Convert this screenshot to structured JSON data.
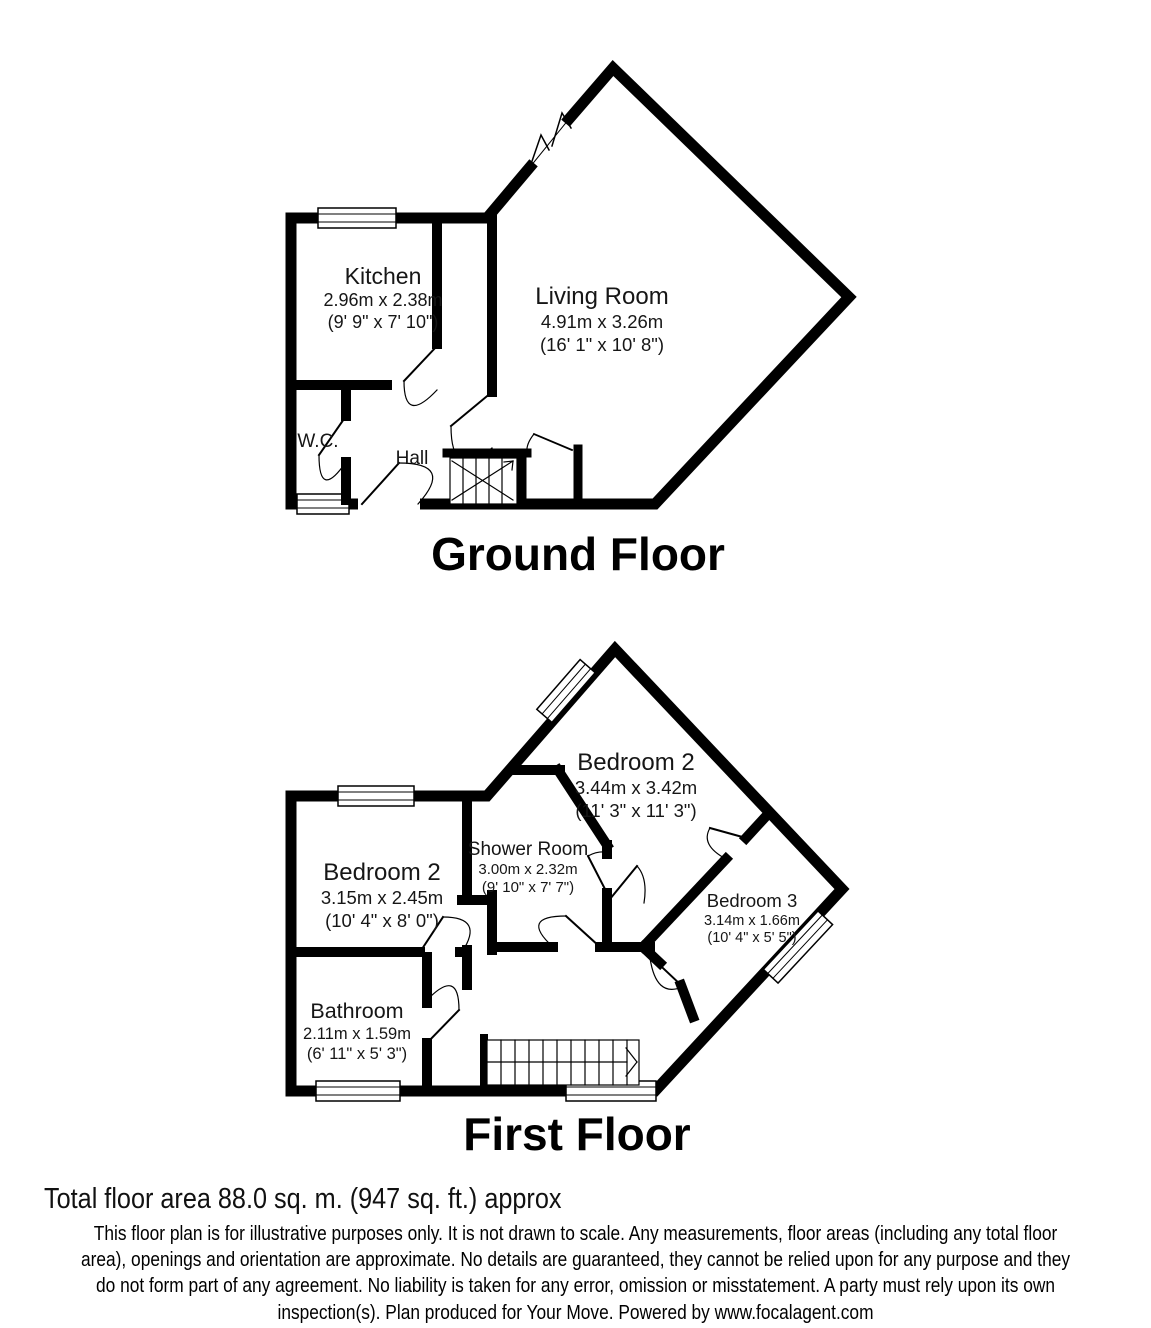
{
  "ground_floor": {
    "title": "Ground Floor",
    "rooms": {
      "kitchen": {
        "name": "Kitchen",
        "metric": "2.96m x 2.38m",
        "imperial": "(9' 9\" x 7' 10\")"
      },
      "living_room": {
        "name": "Living Room",
        "metric": "4.91m x 3.26m",
        "imperial": "(16' 1\" x 10' 8\")"
      },
      "wc": {
        "name": "W.C."
      },
      "hall": {
        "name": "Hall"
      }
    }
  },
  "first_floor": {
    "title": "First Floor",
    "rooms": {
      "bedroom2_main": {
        "name": "Bedroom 2",
        "metric": "3.44m x 3.42m",
        "imperial": "(11' 3\" x 11' 3\")"
      },
      "shower_room": {
        "name": "Shower Room",
        "metric": "3.00m x 2.32m",
        "imperial": "(9' 10\" x 7' 7\")"
      },
      "bedroom2_left": {
        "name": "Bedroom 2",
        "metric": "3.15m x 2.45m",
        "imperial": "(10' 4\" x 8' 0\")"
      },
      "bedroom3": {
        "name": "Bedroom 3",
        "metric": "3.14m x 1.66m",
        "imperial": "(10' 4\" x 5' 5\")"
      },
      "bathroom": {
        "name": "Bathroom",
        "metric": "2.11m x 1.59m",
        "imperial": "(6' 11\" x 5' 3\")"
      }
    }
  },
  "footer": {
    "total_area": "Total floor area 88.0 sq. m. (947 sq. ft.) approx",
    "disclaimer_lines": [
      "This floor plan is for illustrative purposes only. It is not drawn to scale. Any measurements, floor areas (including any total floor",
      "area), openings and orientation are approximate. No details are guaranteed, they cannot be relied upon for any purpose and they",
      "do not form part of any agreement. No liability is taken for any error, omission or misstatement. A party must rely upon its own",
      "inspection(s). Plan produced for Your Move. Powered by www.focalagent.com"
    ]
  },
  "colors": {
    "wall": "#000000",
    "background": "#ffffff"
  }
}
